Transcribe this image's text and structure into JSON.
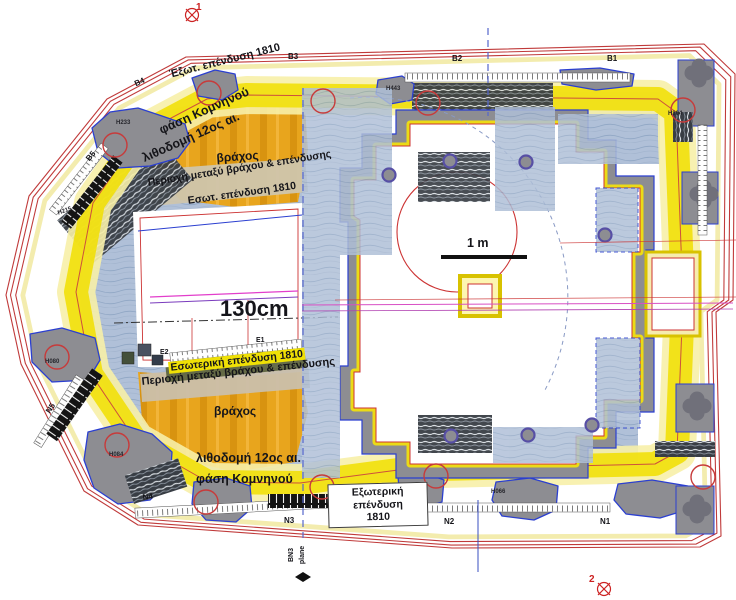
{
  "figure": {
    "type": "architectural-plan",
    "dimension": "130cm",
    "scale_bar": "1 m"
  },
  "labels": {
    "marker_1": "1",
    "marker_2": "2",
    "grid_b5": "B5",
    "grid_b4": "B4",
    "grid_b3": "B3",
    "grid_b2": "B2",
    "grid_b1": "B1",
    "grid_n5": "N5",
    "grid_n4": "N4",
    "grid_n3": "N3",
    "grid_n2": "N2",
    "grid_n1": "N1",
    "grid_e1": "E1",
    "grid_e2": "E2",
    "top_outer_cladding": "Έξωτ. επένδυση 1810",
    "top_phase": "φάση Κομνηνού",
    "top_masonry": "λιθοδομή 12ος αι.",
    "top_rock": "βράχος",
    "top_zone": "Περιοχή μεταξύ βράχου & επένδυσης",
    "top_inner_cladding": "Εσωτ. επένδυση 1810",
    "bottom_inner_cladding": "Εσωτερική επένδυση 1810",
    "bottom_zone": "Περιοχή μεταξύ βράχου & επένδυσης",
    "bottom_rock": "βράχος",
    "bottom_masonry": "λιθοδομή 12ος αι.",
    "bottom_phase": "φάση Κομνηνού",
    "outer_cladding_box_line1": "Εξωτερική επένδυση",
    "outer_cladding_box_line2": "1810",
    "dimension": "130cm",
    "scale_bar": "1 m",
    "bn3_line1": "BN3",
    "bn3_line2": "plane"
  },
  "survey_points": {
    "h233": "H233",
    "h215": "H215",
    "h443": "H443",
    "h304": "H304",
    "h080": "H080",
    "h084": "H084",
    "h066": "H066"
  },
  "colors": {
    "contour_red": "#c03a3a",
    "band_yellow": "#f1df00",
    "band_pale_yellow": "#f7f0a8",
    "rock_orange": "#e8a51d",
    "radar_blue": "#b0c0d8",
    "wall_gray": "#8d8d92",
    "outline_blue": "#2b3fd0",
    "marker_purple": "#574fa5",
    "magenta_line": "#d84fc4"
  }
}
